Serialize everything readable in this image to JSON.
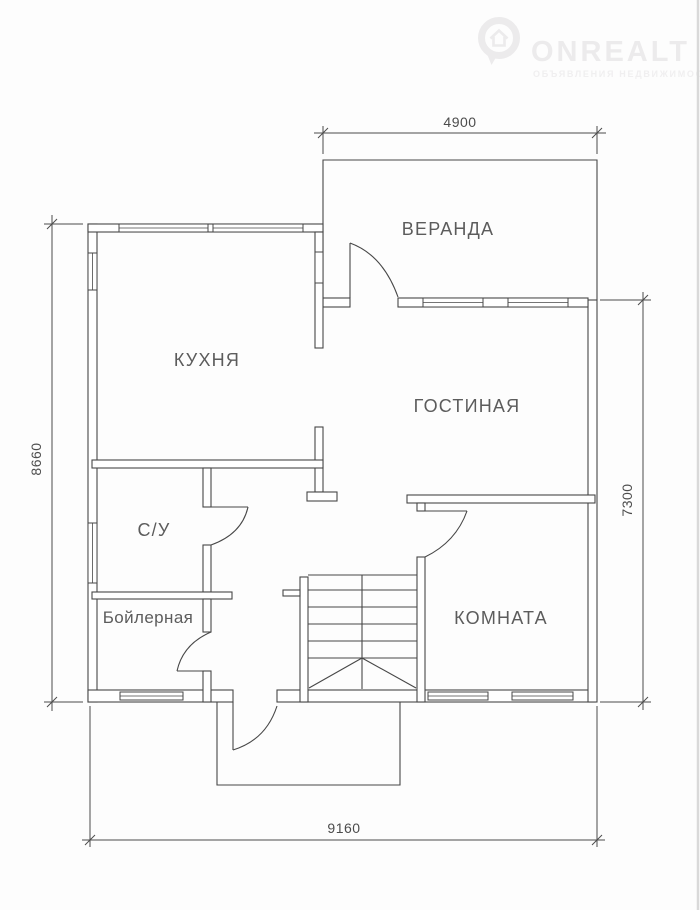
{
  "colors": {
    "line-color": "#474747",
    "label-color": "#5c5c5c",
    "dim-color": "#4c4c4c",
    "watermark-color": "#ecebec",
    "page-bg": "#fdfdfd",
    "edge-color": "#d9d9d9"
  },
  "watermark": {
    "brand": "ONREALT",
    "tagline": "ОБЪЯВЛЕНИЯ НЕДВИЖИМОСТИ",
    "icon": "map-pin-house-icon"
  },
  "rooms": {
    "veranda": "ВЕРАНДА",
    "kitchen": "КУХНЯ",
    "living": "ГОСТИНАЯ",
    "bathroom": "С/У",
    "boiler": "Бойлерная",
    "bedroom": "КОМНАТА"
  },
  "dims": {
    "top": "4900",
    "left": "8660",
    "right": "7300",
    "bottom": "9160"
  }
}
